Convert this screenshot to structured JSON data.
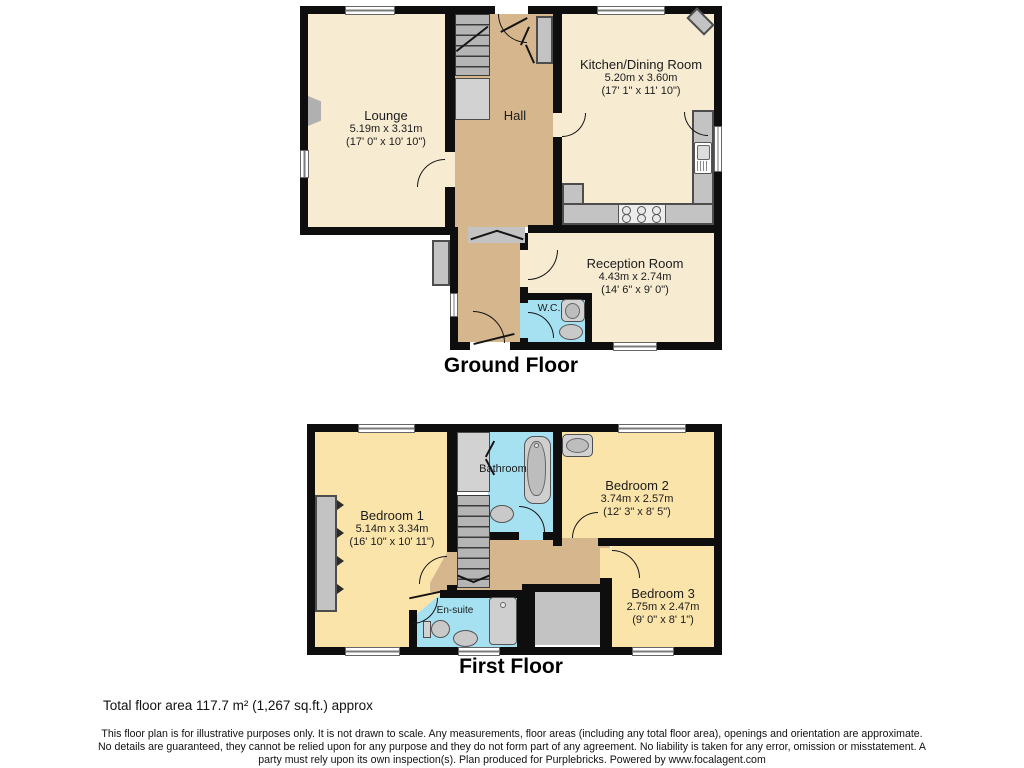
{
  "ground_floor": {
    "title": "Ground Floor",
    "rooms": {
      "lounge": {
        "name": "Lounge",
        "metric": "5.19m x 3.31m",
        "imperial": "(17' 0\" x 10' 10\")"
      },
      "hall": {
        "name": "Hall"
      },
      "kitchen": {
        "name": "Kitchen/Dining Room",
        "metric": "5.20m x 3.60m",
        "imperial": "(17' 1\" x 11' 10\")"
      },
      "reception": {
        "name": "Reception Room",
        "metric": "4.43m x 2.74m",
        "imperial": "(14' 6\" x 9' 0\")"
      },
      "wc": {
        "name": "W.C."
      }
    }
  },
  "first_floor": {
    "title": "First Floor",
    "rooms": {
      "bedroom1": {
        "name": "Bedroom 1",
        "metric": "5.14m x 3.34m",
        "imperial": "(16' 10\" x 10' 11\")"
      },
      "bathroom": {
        "name": "Bathroom"
      },
      "bedroom2": {
        "name": "Bedroom 2",
        "metric": "3.74m x 2.57m",
        "imperial": "(12' 3\" x 8' 5\")"
      },
      "bedroom3": {
        "name": "Bedroom 3",
        "metric": "2.75m x 2.47m",
        "imperial": "(9' 0\" x 8' 1\")"
      },
      "ensuite": {
        "name": "En-suite"
      }
    }
  },
  "footer": {
    "total_area": "Total floor area 117.7 m² (1,267 sq.ft.) approx",
    "disclaimer": "This floor plan is for illustrative purposes only. It is not drawn to scale. Any measurements, floor areas (including any total floor area), openings and orientation are approximate. No details are guaranteed, they cannot be relied upon for any purpose and they do not form part of any agreement. No liability is taken for any error, omission or misstatement. A party must rely upon its own inspection(s). Plan produced for Purplebricks. Powered by www.focalagent.com"
  },
  "colors": {
    "wall": "#0e0e0e",
    "room_cream": "#f7ecd2",
    "room_yellow": "#fae4aa",
    "hall_tan": "#d6b78d",
    "wet_room_blue": "#a6e1f2",
    "fixture_gray": "#c3c3c3",
    "window_white": "#ffffff"
  }
}
